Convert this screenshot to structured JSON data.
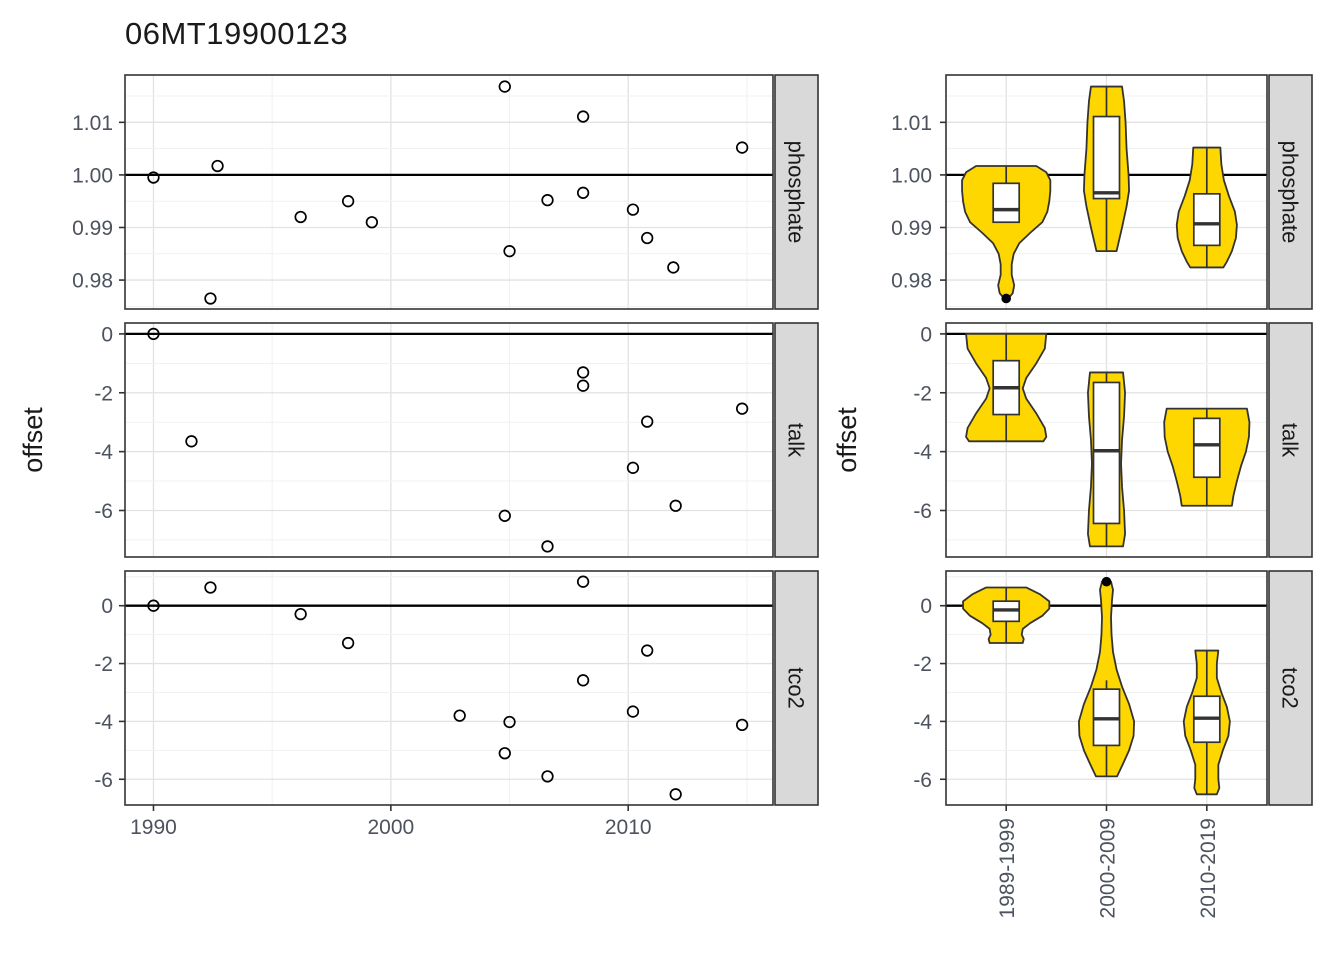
{
  "title": "06MT19900123",
  "colors": {
    "violin_fill": "#FFD700",
    "box_fill": "#FFFFFF",
    "point": "#000000",
    "ref_line": "#000000",
    "grid_major": "#E2E2E2",
    "grid_minor": "#F1F1F1",
    "strip_bg": "#D9D9D9",
    "strip_text": "#1A1A1A",
    "tick_text": "#4D535E",
    "axis_title": "#1A1A1A",
    "panel_bg": "#FFFFFF",
    "border": "#333333",
    "title_text": "#1A1A1A"
  },
  "chart_data": {
    "ylabel": "offset",
    "facets": [
      "phosphate",
      "talk",
      "tco2"
    ],
    "layout": {
      "rows": [
        [
          75,
          309
        ],
        [
          323,
          557
        ],
        [
          571,
          805
        ]
      ],
      "left_panel_x": [
        125,
        773
      ],
      "left_strip_x": [
        775,
        818
      ],
      "right_panel_x": [
        946,
        1267
      ],
      "right_strip_x": [
        1269,
        1312
      ],
      "left_ylab_x": 42,
      "right_ylab_x": 856,
      "left_ytick_label_x": 113,
      "right_ytick_label_x": 932,
      "tick_len": 6,
      "x_label_baseline_y": 834,
      "cat_label_top_y": 818,
      "box_halfwidth": 13,
      "point_r": 5.3,
      "outlier_r": 4.8
    },
    "y_axes": [
      {
        "facet": "phosphate",
        "domain": [
          0.9745,
          1.019
        ],
        "ticks": [
          0.98,
          0.99,
          1.0,
          1.01
        ],
        "tick_labels": [
          "0.98",
          "0.99",
          "1.00",
          "1.01"
        ],
        "minor": [
          0.975,
          0.985,
          0.995,
          1.005,
          1.015
        ],
        "ref": 1.0
      },
      {
        "facet": "talk",
        "domain": [
          -7.58,
          0.37
        ],
        "ticks": [
          0,
          -2,
          -4,
          -6
        ],
        "tick_labels": [
          "0",
          "-2",
          "-4",
          "-6"
        ],
        "minor": [
          -1,
          -3,
          -5,
          -7
        ],
        "ref": 0
      },
      {
        "facet": "tco2",
        "domain": [
          -6.89,
          1.2
        ],
        "ticks": [
          0,
          -2,
          -4,
          -6
        ],
        "tick_labels": [
          "0",
          "-2",
          "-4",
          "-6"
        ],
        "minor": [
          1,
          -1,
          -3,
          -5
        ],
        "ref": 0
      }
    ],
    "left": {
      "type": "scatter",
      "x_domain": [
        1988.8,
        2016.1
      ],
      "x_ticks": [
        1990,
        2000,
        2010
      ],
      "x_tick_labels": [
        "1990",
        "2000",
        "2010"
      ],
      "x_minor": [
        1995,
        2005,
        2015
      ],
      "series": [
        {
          "facet": "phosphate",
          "points": [
            [
              1990.0,
              0.9995
            ],
            [
              1992.7,
              1.0017
            ],
            [
              1992.4,
              0.9765
            ],
            [
              1996.2,
              0.992
            ],
            [
              1998.2,
              0.995
            ],
            [
              1999.2,
              0.991
            ],
            [
              2004.8,
              1.0168
            ],
            [
              2005.0,
              0.9855
            ],
            [
              2006.6,
              0.9952
            ],
            [
              2008.1,
              1.0111
            ],
            [
              2008.1,
              0.9966
            ],
            [
              2010.2,
              0.9934
            ],
            [
              2010.8,
              0.988
            ],
            [
              2011.9,
              0.9824
            ],
            [
              2014.8,
              1.0052
            ]
          ]
        },
        {
          "facet": "talk",
          "points": [
            [
              1990.0,
              0.0
            ],
            [
              1991.6,
              -3.65
            ],
            [
              2004.8,
              -6.18
            ],
            [
              2006.6,
              -7.22
            ],
            [
              2008.1,
              -1.31
            ],
            [
              2008.1,
              -1.76
            ],
            [
              2010.2,
              -4.55
            ],
            [
              2010.8,
              -2.98
            ],
            [
              2012.0,
              -5.84
            ],
            [
              2014.8,
              -2.54
            ]
          ]
        },
        {
          "facet": "tco2",
          "points": [
            [
              1990.0,
              0.0
            ],
            [
              1992.4,
              0.63
            ],
            [
              1996.2,
              -0.29
            ],
            [
              1998.2,
              -1.29
            ],
            [
              2002.9,
              -3.8
            ],
            [
              2004.8,
              -5.1
            ],
            [
              2005.0,
              -4.02
            ],
            [
              2006.6,
              -5.9
            ],
            [
              2008.1,
              0.83
            ],
            [
              2008.1,
              -2.58
            ],
            [
              2010.2,
              -3.66
            ],
            [
              2010.8,
              -1.55
            ],
            [
              2012.0,
              -6.52
            ],
            [
              2014.8,
              -4.12
            ]
          ]
        }
      ]
    },
    "right": {
      "type": "violin",
      "categories": [
        "1989-1999",
        "2000-2009",
        "2010-2019"
      ],
      "cat_domain": [
        0.4,
        3.6
      ],
      "rows": [
        {
          "facet": "phosphate",
          "violins": [
            {
              "category": "1989-1999",
              "profile": [
                [
                  1.0017,
                  0.3
                ],
                [
                  1.0005,
                  0.4
                ],
                [
                  0.999,
                  0.44
                ],
                [
                  0.997,
                  0.44
                ],
                [
                  0.995,
                  0.43
                ],
                [
                  0.993,
                  0.41
                ],
                [
                  0.991,
                  0.36
                ],
                [
                  0.989,
                  0.24
                ],
                [
                  0.987,
                  0.13
                ],
                [
                  0.985,
                  0.075
                ],
                [
                  0.983,
                  0.055
                ],
                [
                  0.981,
                  0.055
                ],
                [
                  0.979,
                  0.08
                ],
                [
                  0.9775,
                  0.065
                ],
                [
                  0.9765,
                  0.02
                ]
              ],
              "box": {
                "wlo": 0.991,
                "blo": 0.991,
                "med": 0.9934,
                "bhi": 0.9984,
                "whi": 1.0017
              },
              "outliers": [
                0.9765
              ]
            },
            {
              "category": "2000-2009",
              "profile": [
                [
                  1.0168,
                  0.155
                ],
                [
                  1.014,
                  0.175
                ],
                [
                  1.01,
                  0.19
                ],
                [
                  1.005,
                  0.2
                ],
                [
                  1.0,
                  0.22
                ],
                [
                  0.997,
                  0.225
                ],
                [
                  0.994,
                  0.2
                ],
                [
                  0.99,
                  0.155
                ],
                [
                  0.9855,
                  0.1
                ]
              ],
              "box": {
                "wlo": 0.9855,
                "blo": 0.9955,
                "med": 0.9966,
                "bhi": 1.0111,
                "whi": 1.0168
              },
              "outliers": []
            },
            {
              "category": "2010-2019",
              "profile": [
                [
                  1.0052,
                  0.135
                ],
                [
                  1.002,
                  0.145
                ],
                [
                  0.999,
                  0.17
                ],
                [
                  0.996,
                  0.22
                ],
                [
                  0.993,
                  0.28
                ],
                [
                  0.9905,
                  0.3
                ],
                [
                  0.988,
                  0.29
                ],
                [
                  0.9855,
                  0.25
                ],
                [
                  0.9835,
                  0.2
                ],
                [
                  0.9824,
                  0.165
                ]
              ],
              "box": {
                "wlo": 0.9824,
                "blo": 0.9866,
                "med": 0.9907,
                "bhi": 0.9964,
                "whi": 1.0052
              },
              "outliers": []
            }
          ]
        },
        {
          "facet": "talk",
          "violins": [
            {
              "category": "1989-1999",
              "profile": [
                [
                  0.0,
                  0.4
                ],
                [
                  -0.5,
                  0.385
                ],
                [
                  -1.0,
                  0.3
                ],
                [
                  -1.5,
                  0.2
                ],
                [
                  -1.85,
                  0.165
                ],
                [
                  -2.2,
                  0.2
                ],
                [
                  -2.7,
                  0.3
                ],
                [
                  -3.2,
                  0.385
                ],
                [
                  -3.5,
                  0.4
                ],
                [
                  -3.65,
                  0.37
                ]
              ],
              "box": {
                "wlo": -3.65,
                "blo": -2.74,
                "med": -1.83,
                "bhi": -0.91,
                "whi": 0.0
              },
              "outliers": []
            },
            {
              "category": "2000-2009",
              "profile": [
                [
                  -1.31,
                  0.165
                ],
                [
                  -2.0,
                  0.185
                ],
                [
                  -2.8,
                  0.175
                ],
                [
                  -3.6,
                  0.155
                ],
                [
                  -4.4,
                  0.145
                ],
                [
                  -5.2,
                  0.155
                ],
                [
                  -6.0,
                  0.175
                ],
                [
                  -6.8,
                  0.185
                ],
                [
                  -7.22,
                  0.165
                ]
              ],
              "box": {
                "wlo": -7.22,
                "blo": -6.44,
                "med": -3.97,
                "bhi": -1.65,
                "whi": -1.31
              },
              "outliers": []
            },
            {
              "category": "2010-2019",
              "profile": [
                [
                  -2.54,
                  0.4
                ],
                [
                  -3.0,
                  0.425
                ],
                [
                  -3.5,
                  0.42
                ],
                [
                  -4.0,
                  0.39
                ],
                [
                  -4.5,
                  0.34
                ],
                [
                  -5.0,
                  0.3
                ],
                [
                  -5.5,
                  0.265
                ],
                [
                  -5.84,
                  0.25
                ]
              ],
              "box": {
                "wlo": -5.84,
                "blo": -4.87,
                "med": -3.77,
                "bhi": -2.87,
                "whi": -2.54
              },
              "outliers": []
            }
          ]
        },
        {
          "facet": "tco2",
          "violins": [
            {
              "category": "1989-1999",
              "profile": [
                [
                  0.63,
                  0.2
                ],
                [
                  0.4,
                  0.335
                ],
                [
                  0.15,
                  0.43
                ],
                [
                  -0.1,
                  0.43
                ],
                [
                  -0.35,
                  0.36
                ],
                [
                  -0.6,
                  0.24
                ],
                [
                  -0.8,
                  0.165
                ],
                [
                  -1.0,
                  0.155
                ],
                [
                  -1.15,
                  0.175
                ],
                [
                  -1.29,
                  0.165
                ]
              ],
              "box": {
                "wlo": -1.29,
                "blo": -0.54,
                "med": -0.145,
                "bhi": 0.157,
                "whi": 0.63
              },
              "outliers": []
            },
            {
              "category": "2000-2009",
              "profile": [
                [
                  0.83,
                  0.045
                ],
                [
                  0.55,
                  0.065
                ],
                [
                  0.2,
                  0.055
                ],
                [
                  -0.4,
                  0.045
                ],
                [
                  -1.0,
                  0.05
                ],
                [
                  -1.6,
                  0.065
                ],
                [
                  -2.2,
                  0.1
                ],
                [
                  -2.8,
                  0.155
                ],
                [
                  -3.4,
                  0.225
                ],
                [
                  -4.0,
                  0.275
                ],
                [
                  -4.5,
                  0.27
                ],
                [
                  -5.0,
                  0.225
                ],
                [
                  -5.5,
                  0.16
                ],
                [
                  -5.9,
                  0.105
                ]
              ],
              "box": {
                "wlo": -5.9,
                "blo": -4.83,
                "med": -3.91,
                "bhi": -2.885,
                "whi": -2.58
              },
              "outliers": [
                0.83
              ]
            },
            {
              "category": "2010-2019",
              "profile": [
                [
                  -1.55,
                  0.115
                ],
                [
                  -2.0,
                  0.1
                ],
                [
                  -2.5,
                  0.1
                ],
                [
                  -3.0,
                  0.145
                ],
                [
                  -3.5,
                  0.2
                ],
                [
                  -4.0,
                  0.23
                ],
                [
                  -4.5,
                  0.215
                ],
                [
                  -5.0,
                  0.16
                ],
                [
                  -5.5,
                  0.115
                ],
                [
                  -6.0,
                  0.115
                ],
                [
                  -6.3,
                  0.125
                ],
                [
                  -6.52,
                  0.1
                ]
              ],
              "box": {
                "wlo": -6.52,
                "blo": -4.72,
                "med": -3.89,
                "bhi": -3.13,
                "whi": -1.55
              },
              "outliers": []
            }
          ]
        }
      ]
    }
  }
}
